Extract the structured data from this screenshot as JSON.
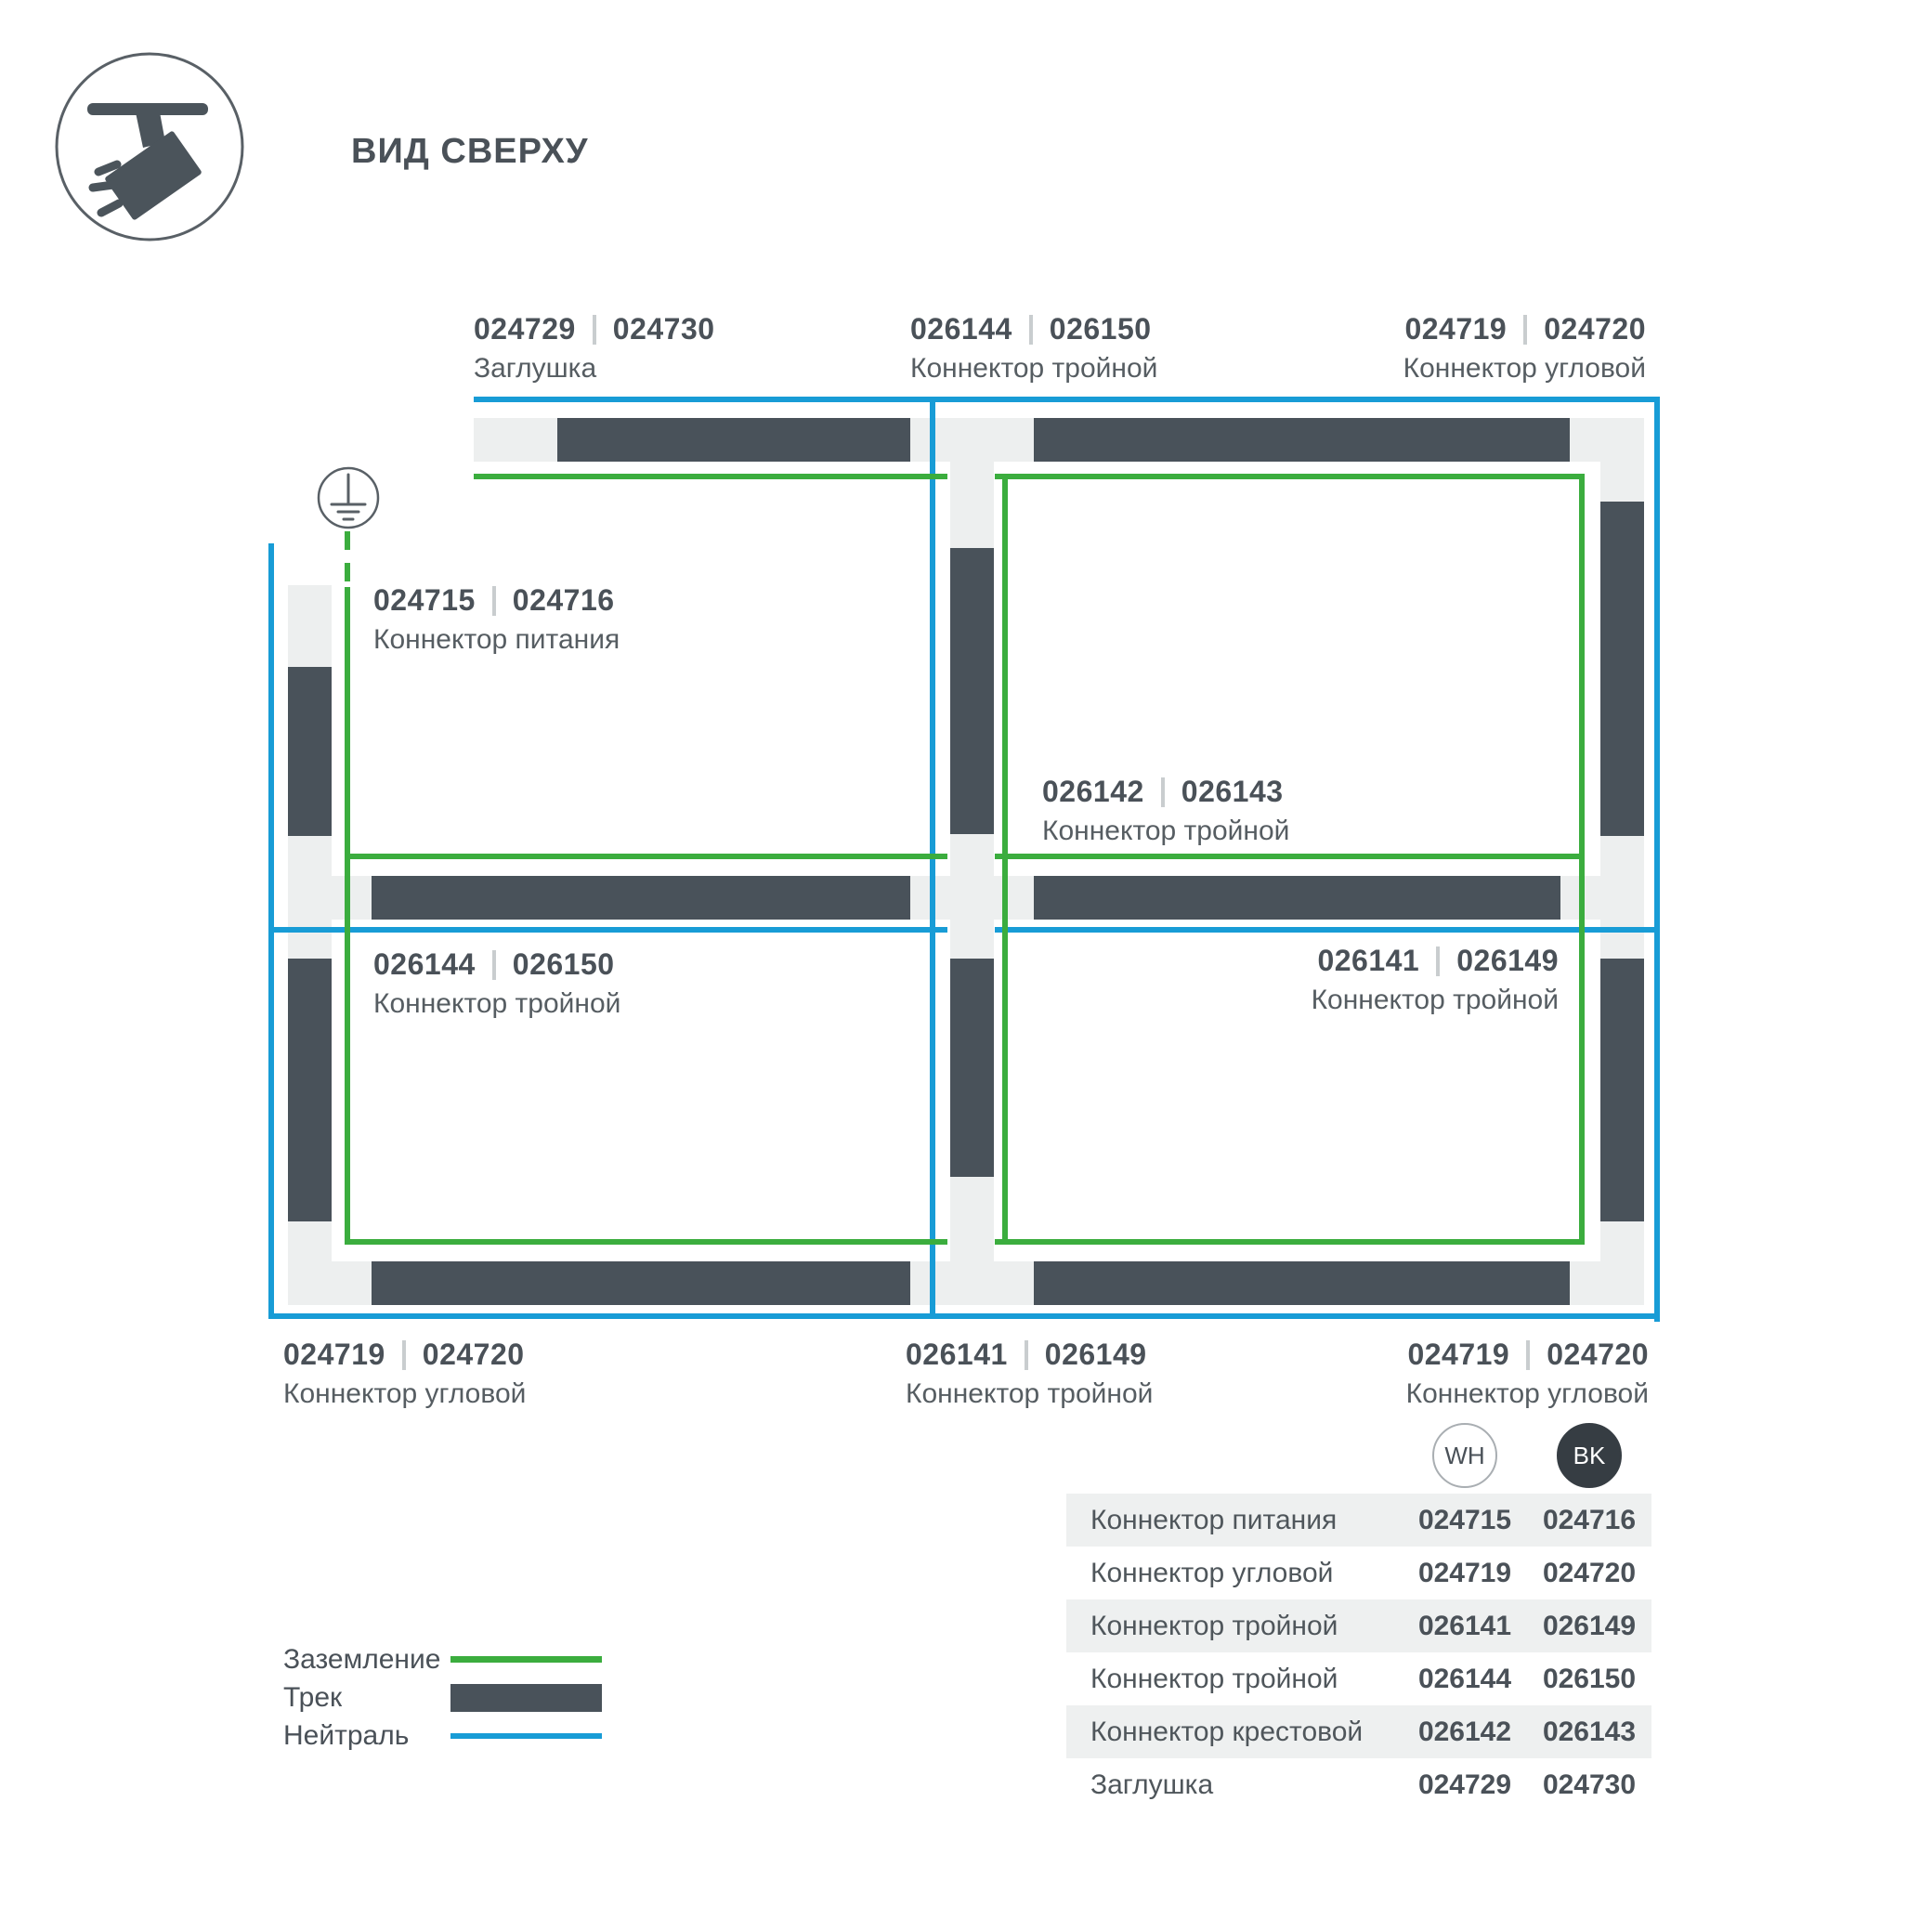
{
  "title": "ВИД СВЕРХУ",
  "colors": {
    "track": "#49525a",
    "connector": "#edefef",
    "ground_green": "#3bad3e",
    "neutral_blue": "#189cd6",
    "text": "#4a5158"
  },
  "callouts": {
    "top_left": {
      "wh": "024729",
      "bk": "024730",
      "name": "Заглушка"
    },
    "top_mid": {
      "wh": "026144",
      "bk": "026150",
      "name": "Коннектор тройной"
    },
    "top_right": {
      "wh": "024719",
      "bk": "024720",
      "name": "Коннектор угловой"
    },
    "power": {
      "wh": "024715",
      "bk": "024716",
      "name": "Коннектор питания"
    },
    "cross": {
      "wh": "026142",
      "bk": "026143",
      "name": "Коннектор тройной"
    },
    "mid_left": {
      "wh": "026144",
      "bk": "026150",
      "name": "Коннектор тройной"
    },
    "mid_right": {
      "wh": "026141",
      "bk": "026149",
      "name": "Коннектор тройной"
    },
    "bottom_left": {
      "wh": "024719",
      "bk": "024720",
      "name": "Коннектор угловой"
    },
    "bottom_mid": {
      "wh": "026141",
      "bk": "026149",
      "name": "Коннектор тройной"
    },
    "bottom_right": {
      "wh": "024719",
      "bk": "024720",
      "name": "Коннектор угловой"
    }
  },
  "legend": {
    "ground": "Заземление",
    "track": "Трек",
    "neutral": "Нейтраль"
  },
  "table": {
    "col_wh": "WH",
    "col_bk": "BK",
    "rows": [
      {
        "name": "Коннектор питания",
        "wh": "024715",
        "bk": "024716"
      },
      {
        "name": "Коннектор угловой",
        "wh": "024719",
        "bk": "024720"
      },
      {
        "name": "Коннектор тройной",
        "wh": "026141",
        "bk": "026149"
      },
      {
        "name": "Коннектор тройной",
        "wh": "026144",
        "bk": "026150"
      },
      {
        "name": "Коннектор крестовой",
        "wh": "026142",
        "bk": "026143"
      },
      {
        "name": "Заглушка",
        "wh": "024729",
        "bk": "024730"
      }
    ]
  }
}
